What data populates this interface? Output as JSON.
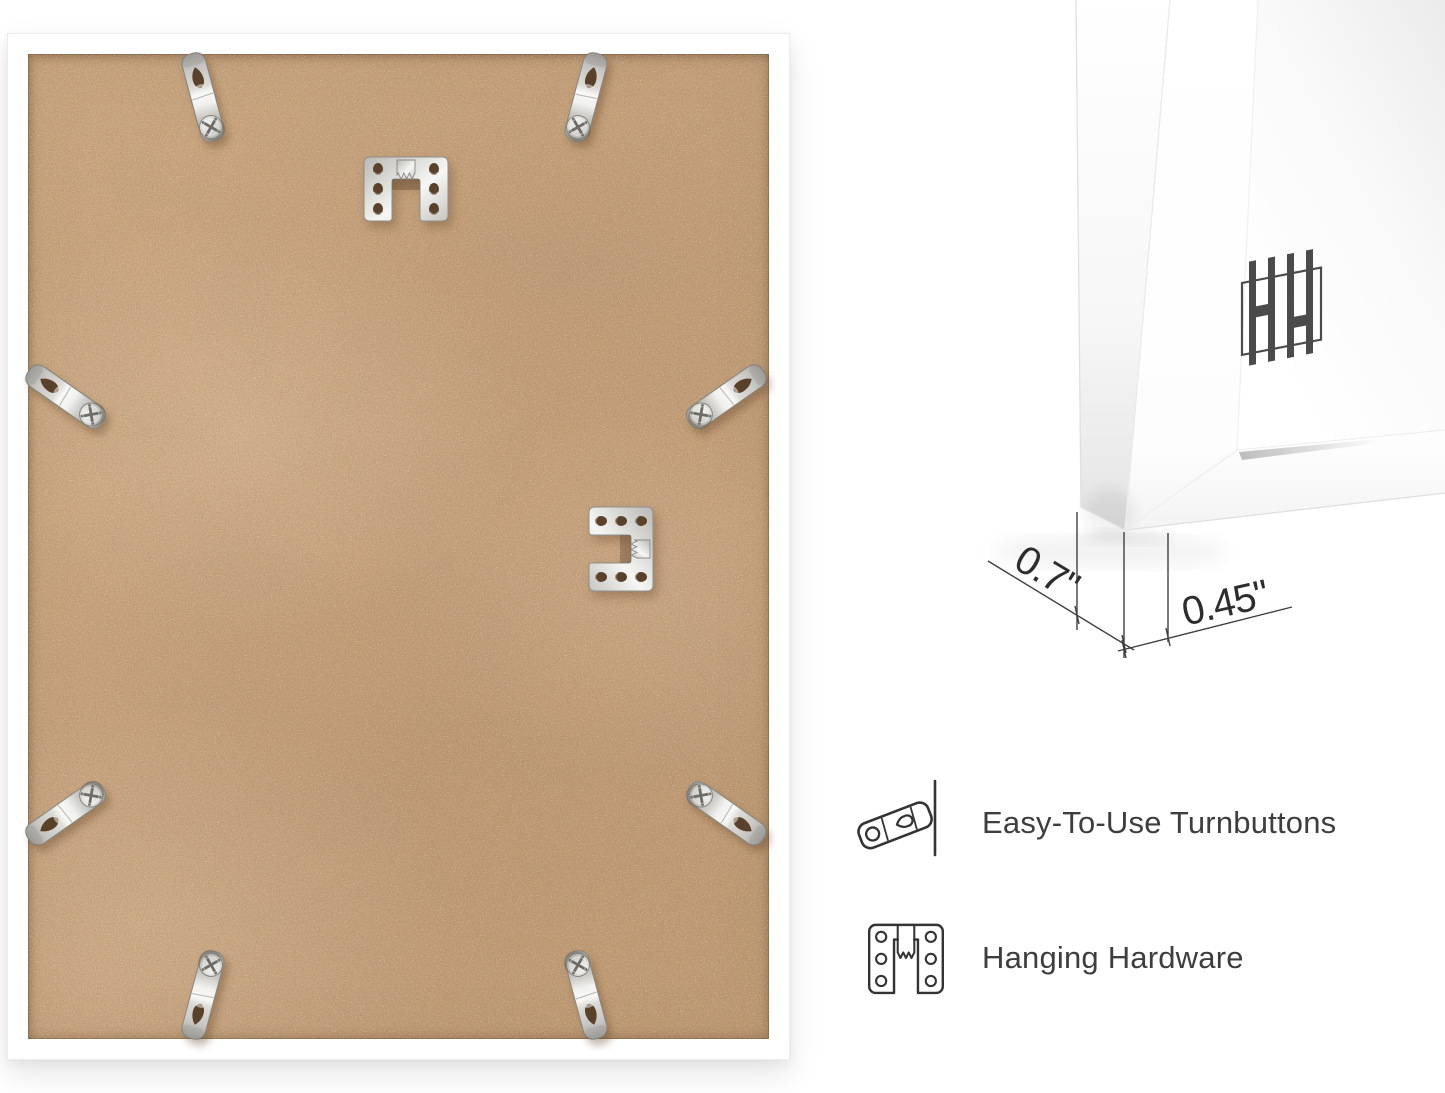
{
  "dimensions": {
    "frame_depth_label": "0.7\"",
    "frame_face_label": "0.45\""
  },
  "features": [
    {
      "icon": "turnbutton-icon",
      "label": "Easy-To-Use Turnbuttons"
    },
    {
      "icon": "hanging-hardware-icon",
      "label": "Hanging Hardware"
    }
  ],
  "brand_logo": {
    "icon": "hh-logo"
  },
  "hardware": {
    "turnbutton_count": 8,
    "sawtooth_hanger_count": 2
  },
  "colors": {
    "mdf_board": "#c7a17d",
    "frame": "#ffffff",
    "metal": "#d6d5d1",
    "dimension_text": "#2d2d2d",
    "feature_text": "#3e3e3e",
    "logo": "#4b4b4b",
    "background": "#ffffff"
  }
}
